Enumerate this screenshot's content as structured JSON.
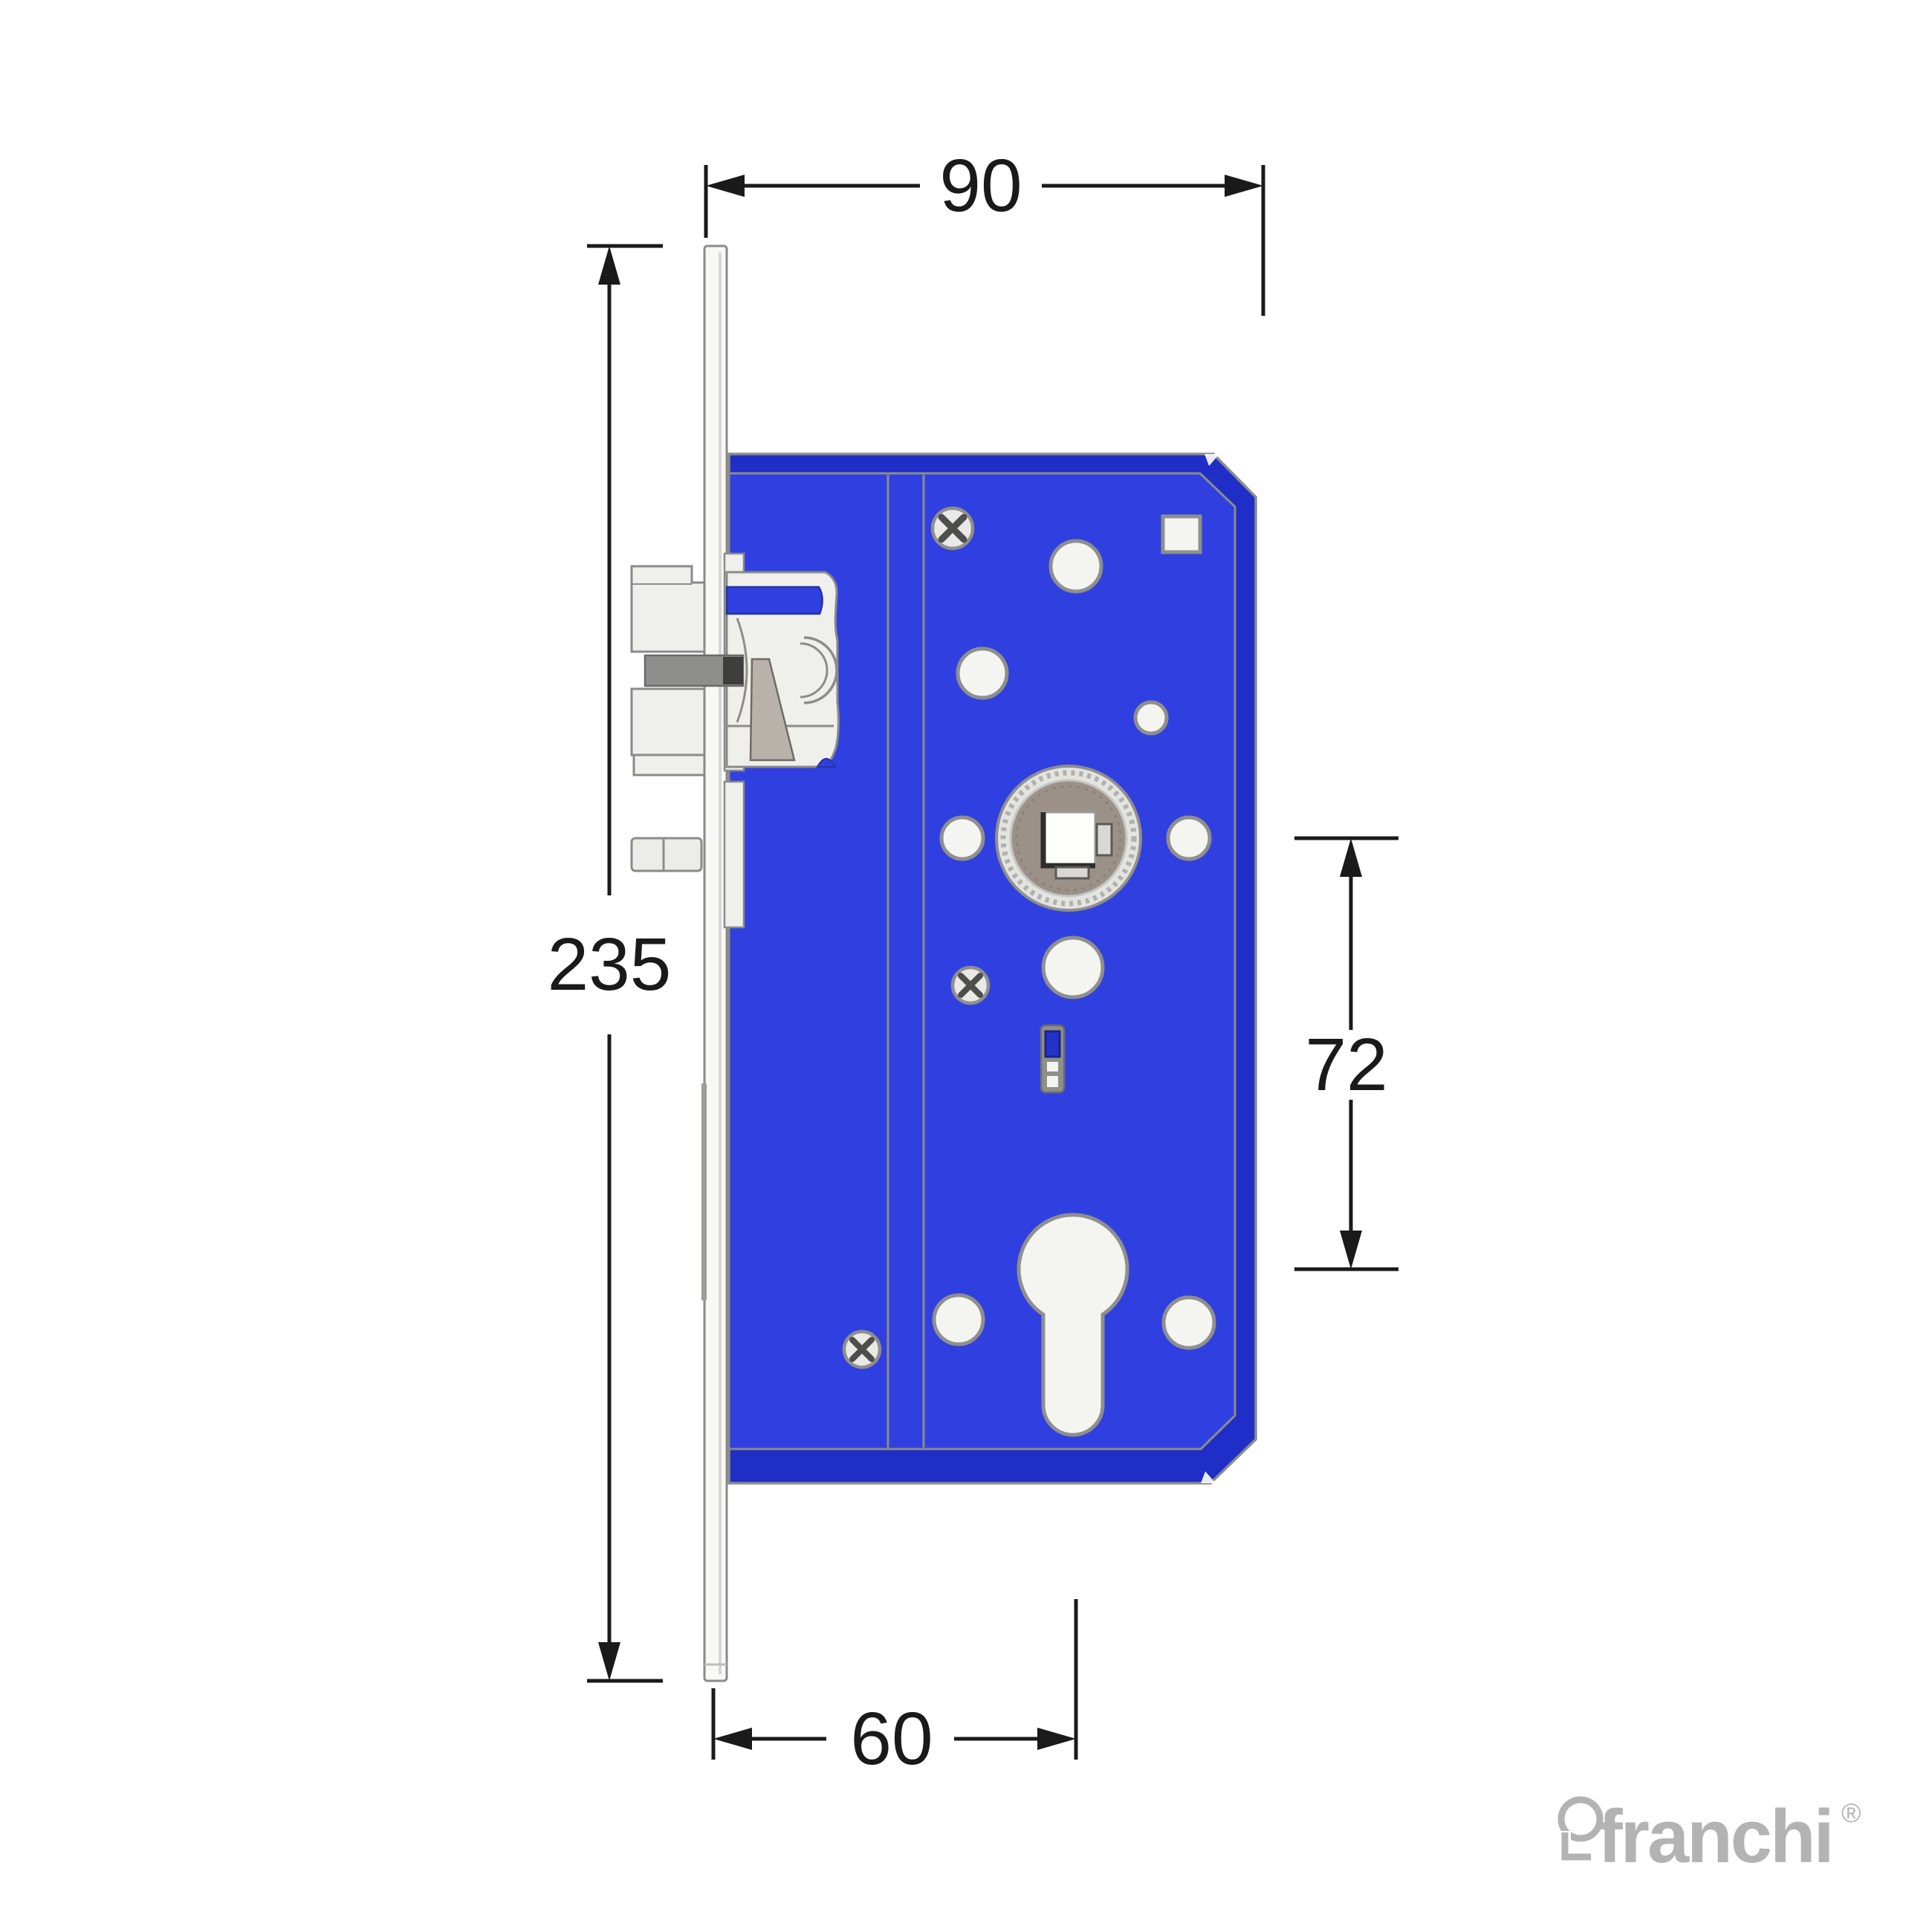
{
  "dimensions": {
    "case_width": {
      "label": "90"
    },
    "faceplate_height": {
      "label": "235"
    },
    "centers_distance": {
      "label": "72"
    },
    "backset": {
      "label": "60"
    }
  },
  "logo": {
    "brand": "franchi",
    "registered_mark": "®"
  },
  "colors": {
    "lock_body_face_blue": "#3040e0",
    "lock_body_side_blue": "#1f2ec6",
    "blue_detail_outline": "#27339f",
    "outline_gray": "#8c8c8a",
    "metal_light": "#efefec",
    "latch_wedge_taupe": "#b9b2aa",
    "hub_disc_taupe": "#9c9189",
    "dark_bar_gray": "#8e8e8c",
    "dimension_black": "#1a1a1a",
    "logo_gray": "#b3b3b3"
  }
}
